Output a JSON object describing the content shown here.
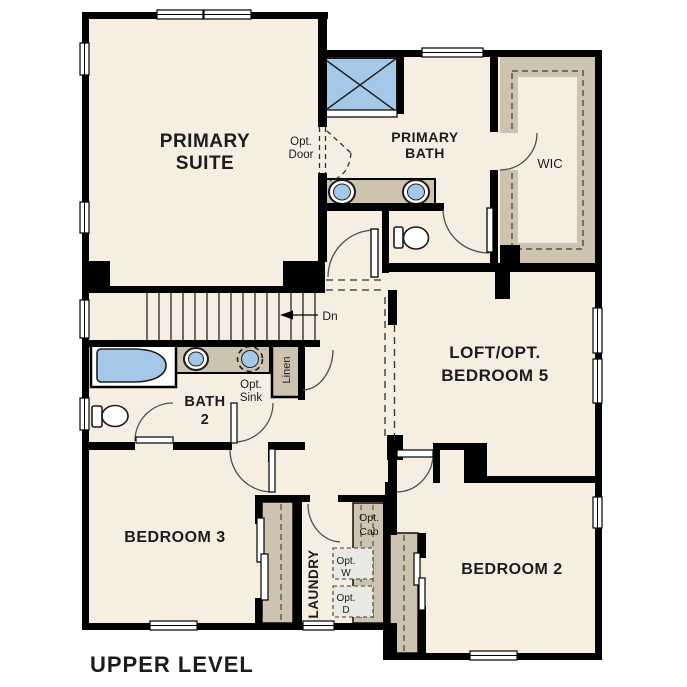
{
  "title": "UPPER LEVEL",
  "colors": {
    "floor": "#f6eee1",
    "wall": "#000000",
    "cabinet_tan": "#cdc3ae",
    "fixture_blue": "#a6c8e8",
    "appliance_gray": "#e9e8e2",
    "arc_stroke": "#555555"
  },
  "rooms": {
    "primary_suite": {
      "line1": "PRIMARY",
      "line2": "SUITE"
    },
    "primary_bath": {
      "line1": "PRIMARY",
      "line2": "BATH"
    },
    "wic": {
      "label": "WIC"
    },
    "loft": {
      "line1": "LOFT/OPT.",
      "line2": "BEDROOM 5"
    },
    "bath2": {
      "line1": "BATH",
      "line2": "2"
    },
    "bedroom3": {
      "label": "BEDROOM 3"
    },
    "bedroom2": {
      "label": "BEDROOM 2"
    },
    "laundry": {
      "label": "LAUNDRY"
    }
  },
  "annotations": {
    "opt_door": {
      "line1": "Opt.",
      "line2": "Door"
    },
    "opt_sink": {
      "line1": "Opt.",
      "line2": "Sink"
    },
    "linen": {
      "label": "Linen"
    },
    "down": {
      "label": "Dn"
    },
    "opt_cab": {
      "line1": "Opt.",
      "line2": "Cab"
    },
    "opt_washer": {
      "line1": "Opt.",
      "line2": "W"
    },
    "opt_dryer": {
      "line1": "Opt.",
      "line2": "D"
    }
  }
}
